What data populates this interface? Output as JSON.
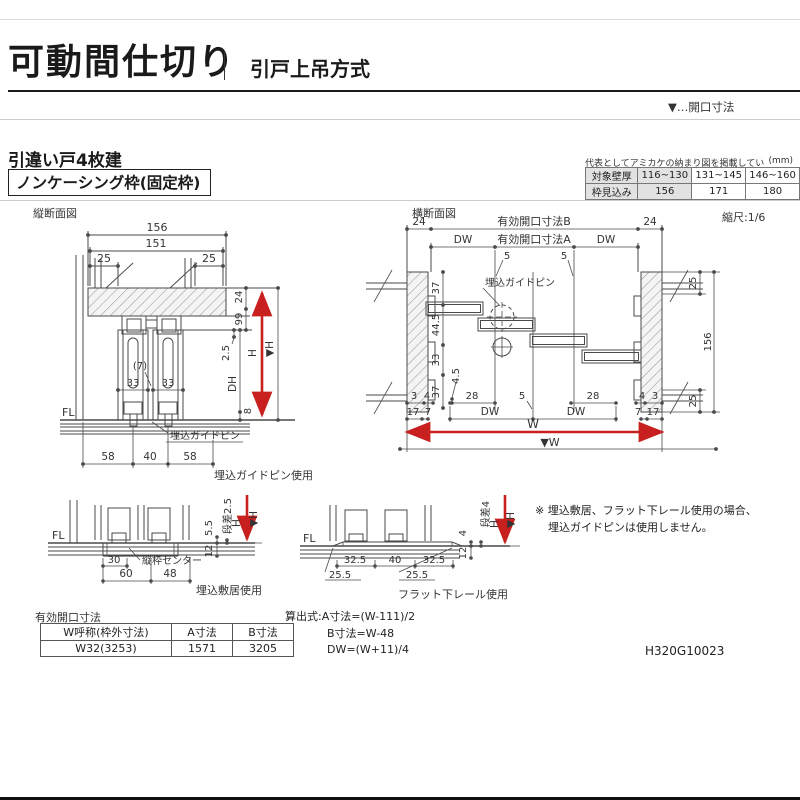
{
  "header": {
    "title": "可動間仕切り",
    "subtitle": "引戸上吊方式",
    "legend": "▼…開口寸法"
  },
  "section": {
    "heading": "引違い戸4枚建",
    "frame_type": "ノンケーシング枠(固定枠)"
  },
  "spec_table": {
    "caption": "代表としてアミカケの納まり図を掲載しています。",
    "unit": "(mm)",
    "row1": {
      "label": "対象壁厚",
      "c1": "116~130",
      "c2": "131~145",
      "c3": "146~160"
    },
    "row2": {
      "label": "枠見込み",
      "c1": "156",
      "c2": "171",
      "c3": "180"
    }
  },
  "vs": {
    "label": "縦断面図",
    "d156": "156",
    "d151": "151",
    "d25l": "25",
    "d25r": "25",
    "d24": "24",
    "d99": "99",
    "d2_5": "2.5",
    "dh": "DH",
    "h": "H",
    "hv": "▼H",
    "d8": "8",
    "fl": "FL",
    "d7": "(7)",
    "d33a": "33",
    "d33b": "33",
    "pin_label": "埋込ガイドピン",
    "d58a": "58",
    "d40": "40",
    "d58b": "58",
    "caption": "埋込ガイドピン使用"
  },
  "cs": {
    "label": "横断面図",
    "scale": "縮尺:1/6",
    "d24l": "24",
    "kbB": "有効開口寸法B",
    "d24r": "24",
    "dwl": "DW",
    "kbA": "有効開口寸法A",
    "dwr": "DW",
    "d5a": "5",
    "d5b": "5",
    "pin_label": "埋込ガイドピン",
    "d37t": "37",
    "d44_5": "44.5",
    "d33": "33",
    "d37b": "37",
    "d4_5": "4.5",
    "d25t": "25",
    "d156": "156",
    "d25b": "25",
    "b3l": "3",
    "b4l": "4",
    "b28l": "28",
    "b5": "5",
    "b28r": "28",
    "b4r": "4",
    "b3r": "3",
    "b17l": "17",
    "b7l": "7",
    "bdwl": "DW",
    "bdwr": "DW",
    "b7r": "7",
    "b17r": "17",
    "w": "W",
    "wv": "▼W"
  },
  "sd": {
    "fl": "FL",
    "dansa": "段差2.5",
    "d5_5": "5.5",
    "d12": "12",
    "h": "H",
    "hv": "▼H",
    "d30": "30",
    "center_label": "縦枠センター",
    "d60": "60",
    "d48": "48",
    "caption": "埋込敷居使用"
  },
  "rd": {
    "fl": "FL",
    "dansa": "段差4",
    "d4": "4",
    "d12": "12",
    "h": "H",
    "hv": "▼H",
    "d32a": "32.5",
    "d40": "40",
    "d32b": "32.5",
    "d25a": "25.5",
    "d25b": "25.5",
    "caption": "フラット下レール使用"
  },
  "note": {
    "line1": "※ 埋込敷居、フラット下レール使用の場合、",
    "line2": "埋込ガイドピンは使用しません。"
  },
  "opening_table": {
    "title": "有効開口寸法",
    "h1": "W呼称(枠外寸法)",
    "h2": "A寸法",
    "h3": "B寸法",
    "c1": "W32(3253)",
    "c2": "1571",
    "c3": "3205"
  },
  "formulas": {
    "line1": "算出式:A寸法=(W-111)/2",
    "line2": "B寸法=W-48",
    "line3": "DW=(W+11)/4"
  },
  "doc_number": "H320G10023",
  "colors": {
    "accent_red": "#c8201e",
    "line": "#4a4a4a"
  }
}
